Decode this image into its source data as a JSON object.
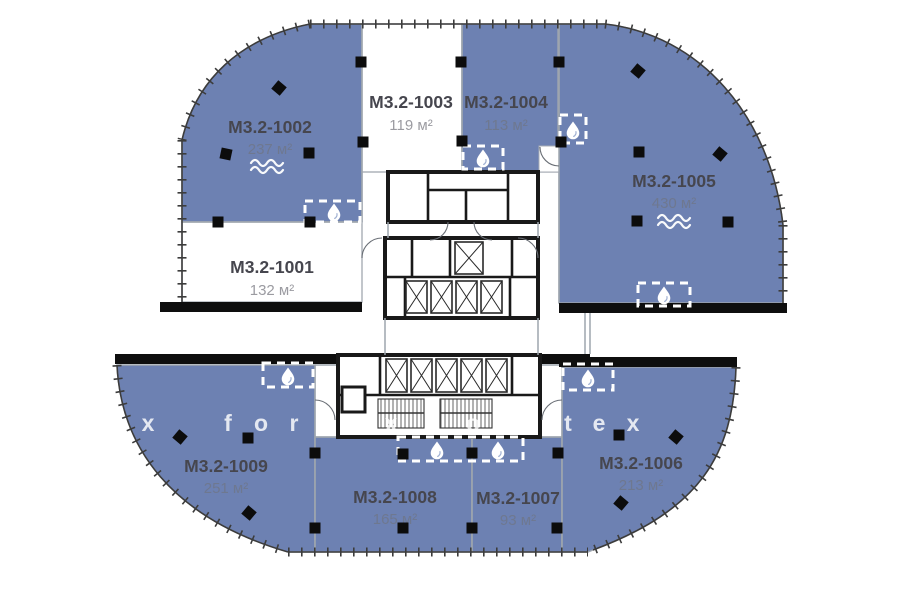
{
  "page": {
    "background": "#ffffff",
    "kind": "floor-plan"
  },
  "units": [
    {
      "id": "M3.2-1001",
      "area": "132 м²",
      "status_fill": "white",
      "wave": false
    },
    {
      "id": "M3.2-1002",
      "area": "237 м²",
      "status_fill": "blue",
      "wave": true
    },
    {
      "id": "M3.2-1003",
      "area": "119 м²",
      "status_fill": "white",
      "wave": false
    },
    {
      "id": "M3.2-1004",
      "area": "113 м²",
      "status_fill": "blue",
      "wave": false
    },
    {
      "id": "M3.2-1005",
      "area": "430 м²",
      "status_fill": "blue",
      "wave": true
    },
    {
      "id": "M3.2-1006",
      "area": "213 м²",
      "status_fill": "blue",
      "wave": false
    },
    {
      "id": "M3.2-1007",
      "area": "93 м²",
      "status_fill": "blue",
      "wave": false
    },
    {
      "id": "M3.2-1008",
      "area": "165 м²",
      "status_fill": "blue",
      "wave": false
    },
    {
      "id": "M3.2-1009",
      "area": "251 м²",
      "status_fill": "blue",
      "wave": false
    }
  ],
  "icons": {
    "water_drop": "water-drop-icon",
    "wave": "wave-icon",
    "column": "column-marker",
    "elevator": "elevator-shaft",
    "stairs": "stairs-block"
  },
  "colors": {
    "unit_available": "#6d81b2",
    "unit_unavailable": "#ffffff",
    "walls": "#0e0e0e",
    "boundaries": "#9ea5ae",
    "label_text": "#46464e",
    "area_text": "#6e7890",
    "watermark": "#ffffff"
  },
  "watermark": {
    "text": "fortex",
    "y": 431,
    "letters": [
      {
        "ch": "x",
        "x": 148
      },
      {
        "ch": "f",
        "x": 228
      },
      {
        "ch": "o",
        "x": 261
      },
      {
        "ch": "r",
        "x": 294
      },
      {
        "ch": "t",
        "x": 327
      },
      {
        "ch": "e",
        "x": 357
      },
      {
        "ch": "x",
        "x": 391
      },
      {
        "ch": "o",
        "x": 473
      },
      {
        "ch": "r",
        "x": 505
      },
      {
        "ch": "t",
        "x": 568
      },
      {
        "ch": "e",
        "x": 599
      },
      {
        "ch": "x",
        "x": 633
      }
    ]
  }
}
